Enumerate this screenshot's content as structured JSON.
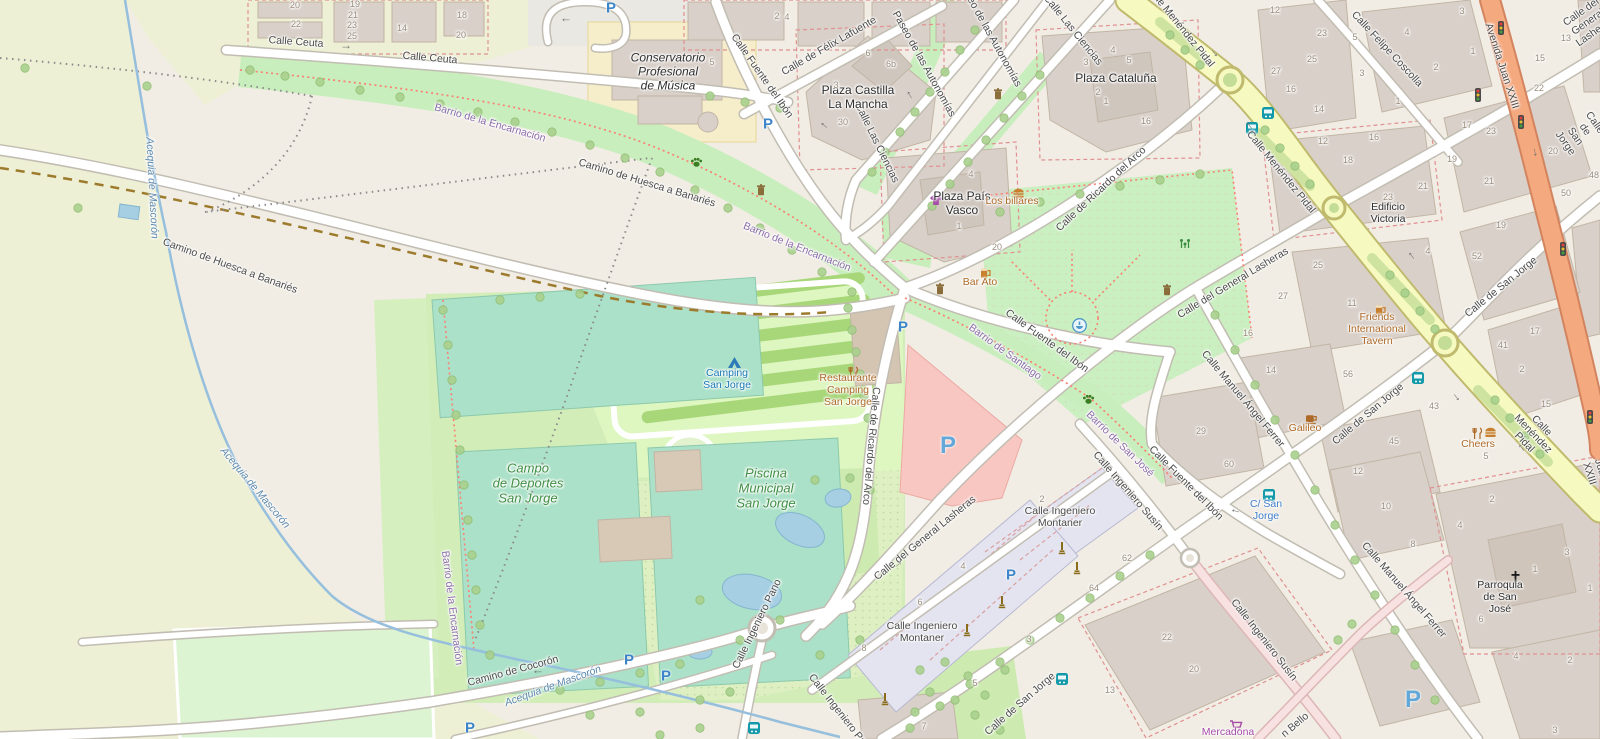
{
  "colors": {
    "base": "#f1ede4",
    "farmland": "#eef0d5",
    "building": "#d9d0c9",
    "apartment_block": "#e4e4f0",
    "road_secondary": "#f7fac0",
    "road_trunk": "#f5a97f",
    "road_minor": "#ffffff",
    "road_living": "#f7e1e1",
    "pitch": "#abe1c8",
    "camping": "#def6c0",
    "grass": "#cdebb0",
    "park": "#caefc0",
    "retail_plaza": "#f9c7c2",
    "water": "#a6cfe3",
    "parking_blue": "#3d85c8",
    "poi_orange": "#ad6a28",
    "shop_purple": "#a64ca6",
    "transport_blue": "#3d7dc9",
    "barrio_purple": "#8d6cab",
    "leisure_green": "#3f8f44",
    "tourism_blue": "#1a78b5"
  },
  "labels": {
    "streets": [
      {
        "text": "Calle Ceuta",
        "x": 296,
        "y": 42,
        "rot": 4
      },
      {
        "text": "Calle Ceuta",
        "x": 430,
        "y": 58,
        "rot": 5
      },
      {
        "text": "Camino de Huesca a Banariés",
        "x": 230,
        "y": 266,
        "rot": 20
      },
      {
        "text": "Camino de Huesca a Banariés",
        "x": 647,
        "y": 183,
        "rot": 17
      },
      {
        "text": "Calle Fuente del Ibón",
        "x": 762,
        "y": 76,
        "rot": 55
      },
      {
        "text": "Calle de Félix Lafuente",
        "x": 829,
        "y": 46,
        "rot": -30
      },
      {
        "text": "Paseo de las Autonomías",
        "x": 924,
        "y": 64,
        "rot": 61
      },
      {
        "text": "Paseo de las Autonomías",
        "x": 990,
        "y": 34,
        "rot": 61
      },
      {
        "text": "Calle Las Ciencias",
        "x": 877,
        "y": 143,
        "rot": 64
      },
      {
        "text": "Calle Las Ciencias",
        "x": 1073,
        "y": 30,
        "rot": 51
      },
      {
        "text": "Calle de Ricardo del Arco",
        "x": 1101,
        "y": 189,
        "rot": -43
      },
      {
        "text": "Calle de Ricardo del Arco",
        "x": 871,
        "y": 446,
        "rot": 95
      },
      {
        "text": "Calle Menéndez Pidal",
        "x": 1180,
        "y": 26,
        "rot": 51
      },
      {
        "text": "Calle Menéndez Pidal",
        "x": 1281,
        "y": 172,
        "rot": 51
      },
      {
        "text": "Calle Menéndez Pidal",
        "x": 1533,
        "y": 434,
        "rot": 46
      },
      {
        "text": "Calle Felipe Coscolla",
        "x": 1387,
        "y": 49,
        "rot": 47
      },
      {
        "text": "Avenida Juan XXIII",
        "x": 1502,
        "y": 66,
        "rot": 72
      },
      {
        "text": "Avenida Juan XXIII",
        "x": 1601,
        "y": 470,
        "rot": 72
      },
      {
        "text": "Calle del General Lasheras",
        "x": 1588,
        "y": 22,
        "rot": -35
      },
      {
        "text": "Calle del General Lasheras",
        "x": 1233,
        "y": 283,
        "rot": -31
      },
      {
        "text": "Calle del General Lasheras",
        "x": 925,
        "y": 538,
        "rot": -39
      },
      {
        "text": "Calle Fuente del Ibón",
        "x": 1047,
        "y": 341,
        "rot": 36
      },
      {
        "text": "Calle Fuente del Ibón",
        "x": 1186,
        "y": 483,
        "rot": 45
      },
      {
        "text": "Calle Manuel Ángel Ferrer",
        "x": 1243,
        "y": 399,
        "rot": 50
      },
      {
        "text": "Calle Manuel Ángel Ferrer",
        "x": 1404,
        "y": 590,
        "rot": 49
      },
      {
        "text": "Calle de San Jorge",
        "x": 1501,
        "y": 287,
        "rot": -39
      },
      {
        "text": "Calle de San Jorge",
        "x": 1368,
        "y": 414,
        "rot": -40
      },
      {
        "text": "Calle de San Jorge",
        "x": 1020,
        "y": 704,
        "rot": -41
      },
      {
        "text": "Calle de San Jorge",
        "x": 1580,
        "y": 133,
        "rot": 55
      },
      {
        "text": "Calle Ingeniero\nMontaner",
        "x": 1060,
        "y": 517,
        "rot": 0
      },
      {
        "text": "Calle Ingeniero\nMontaner",
        "x": 922,
        "y": 632,
        "rot": 0
      },
      {
        "text": "Calle Ingeniero Susín",
        "x": 1128,
        "y": 491,
        "rot": 49
      },
      {
        "text": "Calle Ingeniero Susín",
        "x": 1264,
        "y": 640,
        "rot": 52
      },
      {
        "text": "Calle Ingeniero Pano",
        "x": 757,
        "y": 624,
        "rot": -64
      },
      {
        "text": "Calle Ingeniero Pano",
        "x": 841,
        "y": 714,
        "rot": 52
      },
      {
        "text": "Camino de Cocorón",
        "x": 513,
        "y": 671,
        "rot": -15
      },
      {
        "text": "n Bello",
        "x": 1295,
        "y": 725,
        "rot": -40
      }
    ],
    "places": [
      {
        "text": "Plaza Castilla\nLa Mancha",
        "x": 858,
        "y": 98,
        "rot": 0
      },
      {
        "text": "Plaza País\nVasco",
        "x": 962,
        "y": 204,
        "rot": 0
      },
      {
        "text": "Plaza Cataluña",
        "x": 1116,
        "y": 79,
        "rot": 0
      },
      {
        "text": "Conservatorio\nProfesional\nde Música",
        "x": 668,
        "y": 72,
        "rot": 0,
        "it": 1
      },
      {
        "text": "Edificio\nVictoria",
        "x": 1388,
        "y": 213,
        "rot": 0,
        "size": 10.5
      },
      {
        "text": "Parroquia\nde San\nJosé",
        "x": 1500,
        "y": 597,
        "rot": 0,
        "size": 10.5
      }
    ],
    "barrios": [
      {
        "text": "Barrio de la Encarnación",
        "x": 490,
        "y": 123,
        "rot": 16
      },
      {
        "text": "Barrio de la Encarnación",
        "x": 797,
        "y": 247,
        "rot": 22
      },
      {
        "text": "Barrio de la Encarnación",
        "x": 452,
        "y": 608,
        "rot": 83
      },
      {
        "text": "Barrio de Santiago",
        "x": 1005,
        "y": 352,
        "rot": 36
      },
      {
        "text": "Barrio de San José",
        "x": 1120,
        "y": 444,
        "rot": 44
      }
    ],
    "water": [
      {
        "text": "Acequia de Mascorón",
        "x": 152,
        "y": 188,
        "rot": 87
      },
      {
        "text": "Acequia de Mascorón",
        "x": 255,
        "y": 488,
        "rot": 50
      },
      {
        "text": "Acequia de Mascorón",
        "x": 553,
        "y": 686,
        "rot": -20
      }
    ],
    "leisure": [
      {
        "text": "Campo\nde Deportes\nSan Jorge",
        "x": 528,
        "y": 484,
        "rot": 0
      },
      {
        "text": "Piscina\nMunicipal\nSan Jorge",
        "x": 766,
        "y": 489,
        "rot": 0
      }
    ],
    "tourism": [
      {
        "text": "Camping\nSan Jorge",
        "x": 727,
        "y": 379,
        "rot": 0
      }
    ],
    "pois": [
      {
        "text": "Bar Ato",
        "x": 980,
        "y": 282,
        "rot": 0
      },
      {
        "text": "Los billares",
        "x": 1012,
        "y": 201,
        "rot": 0
      },
      {
        "text": "Friends\nInternational\nTavern",
        "x": 1377,
        "y": 329,
        "rot": 0
      },
      {
        "text": "Galileo",
        "x": 1305,
        "y": 428,
        "rot": 0
      },
      {
        "text": "Cheers",
        "x": 1478,
        "y": 444,
        "rot": 0
      },
      {
        "text": "Restaurante\nCamping\nSan Jorge",
        "x": 848,
        "y": 390,
        "rot": 0
      }
    ],
    "shops": [
      {
        "text": "Mercadona",
        "x": 1228,
        "y": 732,
        "rot": 0
      }
    ],
    "transport": [
      {
        "text": "C/ San\nJorge",
        "x": 1266,
        "y": 510,
        "rot": 0
      }
    ],
    "house_numbers": [
      {
        "text": "20",
        "x": 295,
        "y": 5
      },
      {
        "text": "22",
        "x": 296,
        "y": 24
      },
      {
        "text": "19",
        "x": 355,
        "y": 4
      },
      {
        "text": "21",
        "x": 353,
        "y": 15
      },
      {
        "text": "23",
        "x": 352,
        "y": 25
      },
      {
        "text": "25",
        "x": 352,
        "y": 36
      },
      {
        "text": "14",
        "x": 402,
        "y": 28
      },
      {
        "text": "18",
        "x": 462,
        "y": 15
      },
      {
        "text": "20",
        "x": 461,
        "y": 35
      },
      {
        "text": "2",
        "x": 777,
        "y": 16
      },
      {
        "text": "4",
        "x": 787,
        "y": 17
      },
      {
        "text": "5",
        "x": 712,
        "y": 62
      },
      {
        "text": "6",
        "x": 868,
        "y": 53
      },
      {
        "text": "6b",
        "x": 891,
        "y": 64
      },
      {
        "text": "3",
        "x": 836,
        "y": 85
      },
      {
        "text": "30",
        "x": 843,
        "y": 122
      },
      {
        "text": "4",
        "x": 971,
        "y": 174
      },
      {
        "text": "1",
        "x": 959,
        "y": 226
      },
      {
        "text": "20",
        "x": 997,
        "y": 247
      },
      {
        "text": "3",
        "x": 1086,
        "y": 62
      },
      {
        "text": "4",
        "x": 1113,
        "y": 50
      },
      {
        "text": "5",
        "x": 1129,
        "y": 60
      },
      {
        "text": "2",
        "x": 1098,
        "y": 92
      },
      {
        "text": "1",
        "x": 1106,
        "y": 101
      },
      {
        "text": "16",
        "x": 1146,
        "y": 121
      },
      {
        "text": "12",
        "x": 1275,
        "y": 10
      },
      {
        "text": "27",
        "x": 1276,
        "y": 71
      },
      {
        "text": "25",
        "x": 1312,
        "y": 59
      },
      {
        "text": "16",
        "x": 1291,
        "y": 89
      },
      {
        "text": "14",
        "x": 1319,
        "y": 109
      },
      {
        "text": "12",
        "x": 1323,
        "y": 141
      },
      {
        "text": "16",
        "x": 1374,
        "y": 137
      },
      {
        "text": "18",
        "x": 1348,
        "y": 160
      },
      {
        "text": "23",
        "x": 1322,
        "y": 33
      },
      {
        "text": "5",
        "x": 1355,
        "y": 37
      },
      {
        "text": "3",
        "x": 1362,
        "y": 73
      },
      {
        "text": "4",
        "x": 1407,
        "y": 32
      },
      {
        "text": "2",
        "x": 1436,
        "y": 67
      },
      {
        "text": "1",
        "x": 1473,
        "y": 51
      },
      {
        "text": "3",
        "x": 1462,
        "y": 11
      },
      {
        "text": "1",
        "x": 1398,
        "y": 101
      },
      {
        "text": "17",
        "x": 1467,
        "y": 125
      },
      {
        "text": "23",
        "x": 1491,
        "y": 131
      },
      {
        "text": "19",
        "x": 1452,
        "y": 159
      },
      {
        "text": "21",
        "x": 1423,
        "y": 186
      },
      {
        "text": "21",
        "x": 1489,
        "y": 181
      },
      {
        "text": "23",
        "x": 1388,
        "y": 197
      },
      {
        "text": "19",
        "x": 1501,
        "y": 225
      },
      {
        "text": "13",
        "x": 1566,
        "y": 38
      },
      {
        "text": "15",
        "x": 1540,
        "y": 58
      },
      {
        "text": "22",
        "x": 1539,
        "y": 88
      },
      {
        "text": "20",
        "x": 1553,
        "y": 151
      },
      {
        "text": "48",
        "x": 1594,
        "y": 175
      },
      {
        "text": "50",
        "x": 1566,
        "y": 193
      },
      {
        "text": "25",
        "x": 1318,
        "y": 265
      },
      {
        "text": "27",
        "x": 1283,
        "y": 296
      },
      {
        "text": "11",
        "x": 1352,
        "y": 303
      },
      {
        "text": "4",
        "x": 1428,
        "y": 251
      },
      {
        "text": "52",
        "x": 1477,
        "y": 256
      },
      {
        "text": "17",
        "x": 1535,
        "y": 331
      },
      {
        "text": "41",
        "x": 1503,
        "y": 345
      },
      {
        "text": "2",
        "x": 1522,
        "y": 369
      },
      {
        "text": "15",
        "x": 1546,
        "y": 404
      },
      {
        "text": "56",
        "x": 1348,
        "y": 374
      },
      {
        "text": "43",
        "x": 1434,
        "y": 406
      },
      {
        "text": "45",
        "x": 1394,
        "y": 441
      },
      {
        "text": "12",
        "x": 1358,
        "y": 471
      },
      {
        "text": "5",
        "x": 1486,
        "y": 456
      },
      {
        "text": "16",
        "x": 1248,
        "y": 333
      },
      {
        "text": "14",
        "x": 1271,
        "y": 370
      },
      {
        "text": "29",
        "x": 1201,
        "y": 431
      },
      {
        "text": "60",
        "x": 1229,
        "y": 464
      },
      {
        "text": "10",
        "x": 1386,
        "y": 506
      },
      {
        "text": "2",
        "x": 1042,
        "y": 499
      },
      {
        "text": "62",
        "x": 1127,
        "y": 558
      },
      {
        "text": "64",
        "x": 1094,
        "y": 588
      },
      {
        "text": "4",
        "x": 963,
        "y": 566
      },
      {
        "text": "6",
        "x": 920,
        "y": 602
      },
      {
        "text": "8",
        "x": 864,
        "y": 648
      },
      {
        "text": "3",
        "x": 1029,
        "y": 639
      },
      {
        "text": "5",
        "x": 975,
        "y": 683
      },
      {
        "text": "7",
        "x": 924,
        "y": 726
      },
      {
        "text": "22",
        "x": 1167,
        "y": 637
      },
      {
        "text": "20",
        "x": 1194,
        "y": 669
      },
      {
        "text": "13",
        "x": 1110,
        "y": 690
      },
      {
        "text": "8",
        "x": 1413,
        "y": 544
      },
      {
        "text": "4",
        "x": 1460,
        "y": 525
      },
      {
        "text": "2",
        "x": 1492,
        "y": 499
      },
      {
        "text": "3",
        "x": 1567,
        "y": 552
      },
      {
        "text": "1",
        "x": 1535,
        "y": 569
      },
      {
        "text": "1",
        "x": 1590,
        "y": 588
      },
      {
        "text": "6",
        "x": 1481,
        "y": 619
      },
      {
        "text": "4",
        "x": 1516,
        "y": 656
      },
      {
        "text": "2",
        "x": 1570,
        "y": 660
      },
      {
        "text": "3",
        "x": 1555,
        "y": 730
      }
    ]
  },
  "icons": [
    {
      "type": "parking",
      "x": 611,
      "y": 8
    },
    {
      "type": "parking",
      "x": 768,
      "y": 124
    },
    {
      "type": "parking",
      "x": 903,
      "y": 327
    },
    {
      "type": "parking",
      "x": 948,
      "y": 446,
      "big": 1
    },
    {
      "type": "parking",
      "x": 470,
      "y": 728
    },
    {
      "type": "parking",
      "x": 629,
      "y": 660
    },
    {
      "type": "parking",
      "x": 666,
      "y": 676
    },
    {
      "type": "parking",
      "x": 1011,
      "y": 575
    },
    {
      "type": "parking",
      "x": 1413,
      "y": 700,
      "big": 1
    },
    {
      "type": "bus",
      "x": 1262,
      "y": 107
    },
    {
      "type": "bus",
      "x": 1246,
      "y": 122
    },
    {
      "type": "bus",
      "x": 1412,
      "y": 372
    },
    {
      "type": "bus",
      "x": 1263,
      "y": 489
    },
    {
      "type": "bus",
      "x": 1056,
      "y": 673
    },
    {
      "type": "bus",
      "x": 748,
      "y": 722
    },
    {
      "type": "traffic",
      "x": 1498,
      "y": 21
    },
    {
      "type": "traffic",
      "x": 1475,
      "y": 88
    },
    {
      "type": "traffic",
      "x": 1518,
      "y": 115
    },
    {
      "type": "traffic",
      "x": 1560,
      "y": 242
    },
    {
      "type": "traffic",
      "x": 1587,
      "y": 410
    },
    {
      "type": "bin",
      "x": 756,
      "y": 184
    },
    {
      "type": "bin",
      "x": 993,
      "y": 88
    },
    {
      "type": "bin",
      "x": 1162,
      "y": 284
    },
    {
      "type": "bin",
      "x": 935,
      "y": 283
    },
    {
      "type": "paw",
      "x": 690,
      "y": 156
    },
    {
      "type": "paw",
      "x": 1082,
      "y": 393
    },
    {
      "type": "fountain",
      "x": 1072,
      "y": 318
    },
    {
      "type": "playground",
      "x": 1178,
      "y": 237
    },
    {
      "type": "monument",
      "x": 998,
      "y": 595
    },
    {
      "type": "monument",
      "x": 963,
      "y": 623
    },
    {
      "type": "monument",
      "x": 881,
      "y": 692
    },
    {
      "type": "monument",
      "x": 1058,
      "y": 541
    },
    {
      "type": "monument",
      "x": 1073,
      "y": 561
    },
    {
      "type": "tent",
      "x": 727,
      "y": 356
    },
    {
      "type": "cross",
      "x": 1510,
      "y": 570
    },
    {
      "type": "cart",
      "x": 1229,
      "y": 719
    },
    {
      "type": "tshirt",
      "x": 929,
      "y": 194
    },
    {
      "type": "beer",
      "x": 980,
      "y": 266
    },
    {
      "type": "beer",
      "x": 1375,
      "y": 303
    },
    {
      "type": "coffee",
      "x": 1305,
      "y": 413
    },
    {
      "type": "burger",
      "x": 1012,
      "y": 188
    },
    {
      "type": "burger",
      "x": 1484,
      "y": 427
    },
    {
      "type": "restaurant",
      "x": 848,
      "y": 366
    },
    {
      "type": "restaurant",
      "x": 1472,
      "y": 427
    },
    {
      "type": "arrow",
      "x": 346,
      "y": 45,
      "rot": 0
    },
    {
      "type": "arrow",
      "x": 823,
      "y": 127,
      "rot": -140
    },
    {
      "type": "arrow",
      "x": 908,
      "y": 96,
      "rot": -120
    },
    {
      "type": "arrow",
      "x": 1216,
      "y": 52,
      "rot": 52
    },
    {
      "type": "arrow",
      "x": 1248,
      "y": 127,
      "rot": -128
    },
    {
      "type": "arrow",
      "x": 1410,
      "y": 257,
      "rot": -128
    },
    {
      "type": "arrow",
      "x": 1458,
      "y": 396,
      "rot": 52
    },
    {
      "type": "arrow",
      "x": 1520,
      "y": 449,
      "rot": -128
    },
    {
      "type": "arrow",
      "x": 897,
      "y": 563,
      "rot": -40
    },
    {
      "type": "arrow",
      "x": 1152,
      "y": 521,
      "rot": -40
    },
    {
      "type": "arrow",
      "x": 538,
      "y": 674,
      "rot": 180
    },
    {
      "type": "arrow",
      "x": 566,
      "y": 22,
      "rot": 180
    },
    {
      "type": "arrow",
      "x": 1537,
      "y": 152,
      "rot": 80
    },
    {
      "type": "arrow",
      "x": 1235,
      "y": 513,
      "rot": 195
    }
  ]
}
